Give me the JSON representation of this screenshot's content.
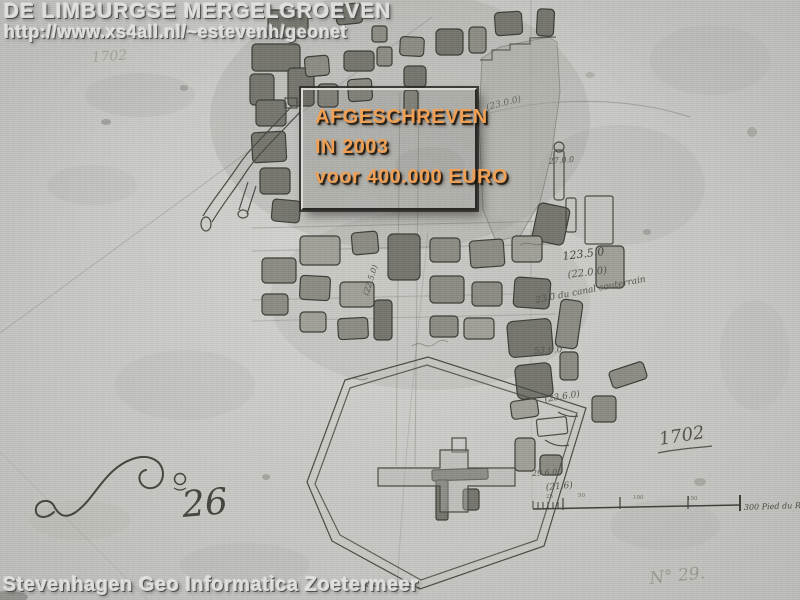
{
  "header": {
    "title": "DE LIMBURGSE MERGELGROEVEN",
    "url": "http://www.xs4all.nl/~estevenh/geonet"
  },
  "stamp": {
    "line1": "AFGESCHREVEN",
    "line2": "IN 2003",
    "line3": "voor 400.000 EURO",
    "text_color": "#f0a055"
  },
  "footer": {
    "credit": "Stevenhagen Geo Informatica Zoetermeer"
  },
  "map": {
    "year_top_left": "1702",
    "year_right": "1702",
    "plate_number_digits": "26",
    "plate_number_secondary": "N° 29.",
    "scale_label": "300 Pied du Rhin",
    "scale_ticks": [
      "25",
      "50",
      "100",
      "150"
    ],
    "annotations": [
      {
        "text": "(23.0.0)"
      },
      {
        "text": "27.0.0"
      },
      {
        "text": "123.5.0"
      },
      {
        "text": "(22.0.0)"
      },
      {
        "text": "23.0 du canal souterrain"
      },
      {
        "text": "53.6.0"
      },
      {
        "text": "(23.6.0)"
      },
      {
        "text": "29.6.0"
      },
      {
        "text": "(21.6)"
      },
      {
        "text": "(22.5.0)"
      }
    ]
  },
  "colors": {
    "paper": "#c7c7c3",
    "pillar_dark": "#76766f",
    "ink": "#4b4b45",
    "stamp_orange": "#f0a055"
  }
}
